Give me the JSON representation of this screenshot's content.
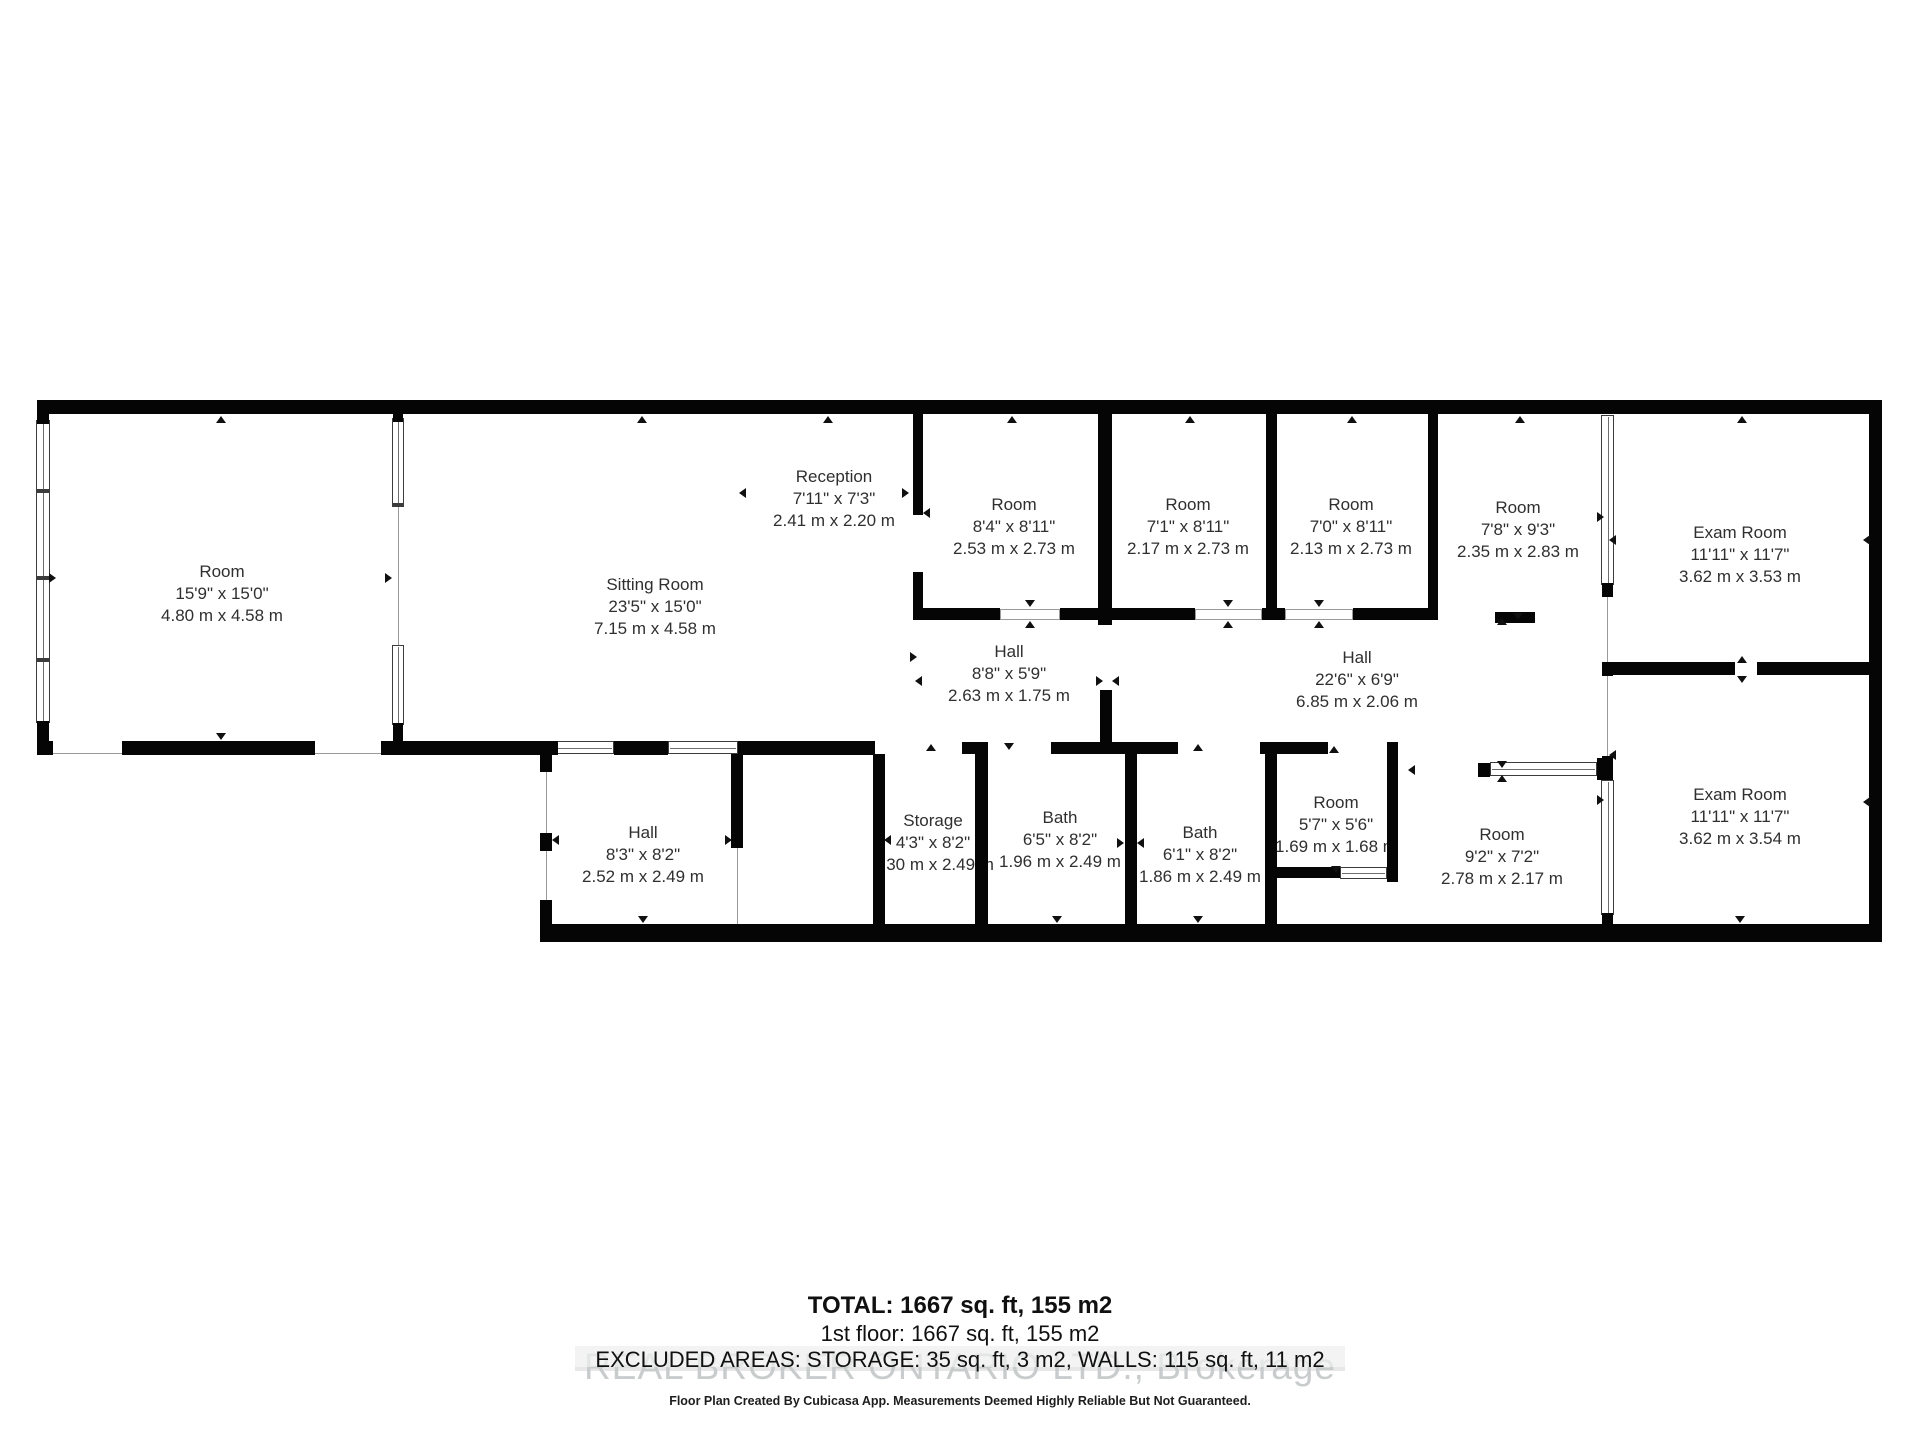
{
  "footer": {
    "total": "TOTAL: 1667 sq. ft, 155 m2",
    "floor": "1st floor: 1667 sq. ft, 155 m2",
    "excluded": "EXCLUDED AREAS: STORAGE: 35 sq. ft, 3 m2, WALLS: 115 sq. ft, 11 m2",
    "watermark": "REAL BROKER ONTARIO LTD., Brokerage",
    "disclaimer": "Floor Plan Created By Cubicasa App. Measurements Deemed Highly Reliable But Not Guaranteed."
  },
  "colors": {
    "wall": "#050505",
    "label_text": "#2f2f2f",
    "thin_line": "#9a9a9a",
    "watermark": "#c9cccd",
    "band": "#e7e7e7"
  },
  "rooms": [
    {
      "name": "Room",
      "imperial": "15'9\" x 15'0\"",
      "metric": "4.80 m x 4.58 m",
      "cx": 222,
      "top": 561
    },
    {
      "name": "Sitting Room",
      "imperial": "23'5\" x 15'0\"",
      "metric": "7.15 m x 4.58 m",
      "cx": 655,
      "top": 574
    },
    {
      "name": "Reception",
      "imperial": "7'11\" x 7'3\"",
      "metric": "2.41 m x 2.20 m",
      "cx": 834,
      "top": 466
    },
    {
      "name": "Room",
      "imperial": "8'4\" x 8'11\"",
      "metric": "2.53 m x 2.73 m",
      "cx": 1014,
      "top": 494
    },
    {
      "name": "Room",
      "imperial": "7'1\" x 8'11\"",
      "metric": "2.17 m x 2.73 m",
      "cx": 1188,
      "top": 494
    },
    {
      "name": "Room",
      "imperial": "7'0\" x 8'11\"",
      "metric": "2.13 m x 2.73 m",
      "cx": 1351,
      "top": 494
    },
    {
      "name": "Room",
      "imperial": "7'8\" x 9'3\"",
      "metric": "2.35 m x 2.83 m",
      "cx": 1518,
      "top": 497
    },
    {
      "name": "Exam Room",
      "imperial": "11'11\" x 11'7\"",
      "metric": "3.62 m x 3.53 m",
      "cx": 1740,
      "top": 522
    },
    {
      "name": "Hall",
      "imperial": "8'8\" x 5'9\"",
      "metric": "2.63 m x 1.75 m",
      "cx": 1009,
      "top": 641
    },
    {
      "name": "Hall",
      "imperial": "22'6\" x 6'9\"",
      "metric": "6.85 m x 2.06 m",
      "cx": 1357,
      "top": 647
    },
    {
      "name": "Exam Room",
      "imperial": "11'11\" x 11'7\"",
      "metric": "3.62 m x 3.54 m",
      "cx": 1740,
      "top": 784
    },
    {
      "name": "Hall",
      "imperial": "8'3\" x 8'2\"",
      "metric": "2.52 m x 2.49 m",
      "cx": 643,
      "top": 822
    },
    {
      "name": "Storage",
      "imperial": "4'3\" x 8'2\"",
      "metric": "1.30 m x 2.49 m",
      "cx": 933,
      "top": 810
    },
    {
      "name": "Bath",
      "imperial": "6'5\" x 8'2\"",
      "metric": "1.96 m x 2.49 m",
      "cx": 1060,
      "top": 807
    },
    {
      "name": "Bath",
      "imperial": "6'1\" x 8'2\"",
      "metric": "1.86 m x 2.49 m",
      "cx": 1200,
      "top": 822
    },
    {
      "name": "Room",
      "imperial": "5'7\" x 5'6\"",
      "metric": "1.69 m x 1.68 m",
      "cx": 1336,
      "top": 792
    },
    {
      "name": "Room",
      "imperial": "9'2\" x 7'2\"",
      "metric": "2.78 m x 2.17 m",
      "cx": 1502,
      "top": 824
    }
  ],
  "plan": {
    "walls": [
      [
        37,
        400,
        1845,
        14
      ],
      [
        1869,
        400,
        13,
        542
      ],
      [
        37,
        414,
        12,
        10
      ],
      [
        37,
        721,
        12,
        22
      ],
      [
        37,
        741,
        16,
        14
      ],
      [
        393,
        414,
        10,
        8
      ],
      [
        393,
        723,
        10,
        18
      ],
      [
        913,
        414,
        10,
        101
      ],
      [
        913,
        572,
        10,
        36
      ],
      [
        1098,
        414,
        14,
        211
      ],
      [
        1100,
        690,
        12,
        52
      ],
      [
        1266,
        414,
        11,
        206
      ],
      [
        1428,
        414,
        10,
        206
      ],
      [
        913,
        608,
        87,
        12
      ],
      [
        1060,
        608,
        135,
        12
      ],
      [
        1262,
        608,
        23,
        12
      ],
      [
        1353,
        608,
        82,
        12
      ],
      [
        1495,
        612,
        40,
        11
      ],
      [
        122,
        741,
        193,
        14
      ],
      [
        381,
        741,
        177,
        14
      ],
      [
        614,
        741,
        54,
        14
      ],
      [
        738,
        741,
        137,
        14
      ],
      [
        962,
        742,
        26,
        12
      ],
      [
        1051,
        742,
        127,
        12
      ],
      [
        1260,
        742,
        68,
        12
      ],
      [
        1387,
        742,
        11,
        12
      ],
      [
        873,
        754,
        12,
        172
      ],
      [
        975,
        754,
        13,
        172
      ],
      [
        1125,
        754,
        12,
        172
      ],
      [
        1265,
        742,
        12,
        184
      ],
      [
        1387,
        754,
        11,
        128
      ],
      [
        1277,
        867,
        63,
        11
      ],
      [
        1387,
        867,
        11,
        15
      ],
      [
        540,
        754,
        12,
        18
      ],
      [
        540,
        833,
        12,
        18
      ],
      [
        540,
        900,
        12,
        26
      ],
      [
        731,
        754,
        12,
        94
      ],
      [
        540,
        924,
        1342,
        18
      ],
      [
        1478,
        763,
        12,
        14
      ],
      [
        1597,
        758,
        16,
        22
      ],
      [
        1602,
        583,
        11,
        14
      ],
      [
        1602,
        662,
        11,
        14
      ],
      [
        1602,
        756,
        11,
        24
      ],
      [
        1602,
        913,
        11,
        17
      ],
      [
        1613,
        662,
        122,
        13
      ],
      [
        1757,
        662,
        113,
        13
      ]
    ],
    "windows_v": [
      [
        36,
        420,
        14,
        303
      ],
      [
        392,
        418,
        12,
        88
      ],
      [
        392,
        645,
        12,
        80
      ],
      [
        1601,
        415,
        13,
        170
      ],
      [
        1601,
        780,
        13,
        135
      ]
    ],
    "windows_h": [
      [
        556,
        741,
        58,
        13
      ],
      [
        668,
        741,
        70,
        13
      ],
      [
        1490,
        762,
        107,
        14
      ],
      [
        1340,
        867,
        47,
        12
      ]
    ],
    "mullions": [
      [
        36,
        489,
        14,
        4
      ],
      [
        36,
        576,
        14,
        4
      ],
      [
        36,
        658,
        14,
        4
      ],
      [
        392,
        503,
        12,
        4
      ]
    ],
    "openings": [
      [
        1000,
        609,
        60,
        11
      ],
      [
        1195,
        609,
        67,
        11
      ],
      [
        1285,
        609,
        68,
        11
      ]
    ],
    "lines": [
      [
        398,
        506,
        1,
        139
      ],
      [
        53,
        753,
        69,
        1
      ],
      [
        315,
        753,
        66,
        1
      ],
      [
        546,
        772,
        1,
        130
      ],
      [
        737,
        848,
        1,
        76
      ],
      [
        1607,
        597,
        1,
        65
      ],
      [
        1607,
        676,
        1,
        80
      ]
    ],
    "arrows": [
      [
        221,
        420,
        "up"
      ],
      [
        642,
        420,
        "up"
      ],
      [
        828,
        420,
        "up"
      ],
      [
        1012,
        420,
        "up"
      ],
      [
        1190,
        420,
        "up"
      ],
      [
        1352,
        420,
        "up"
      ],
      [
        1520,
        420,
        "up"
      ],
      [
        1742,
        420,
        "up"
      ],
      [
        52,
        578,
        "right"
      ],
      [
        388,
        578,
        "right"
      ],
      [
        221,
        736,
        "down"
      ],
      [
        905,
        493,
        "right"
      ],
      [
        927,
        513,
        "left"
      ],
      [
        743,
        493,
        "left"
      ],
      [
        1030,
        603,
        "down"
      ],
      [
        1030,
        625,
        "up"
      ],
      [
        1228,
        603,
        "down"
      ],
      [
        1228,
        625,
        "up"
      ],
      [
        1319,
        603,
        "down"
      ],
      [
        1319,
        625,
        "up"
      ],
      [
        1502,
        622,
        "up"
      ],
      [
        1518,
        616,
        "down"
      ],
      [
        1099,
        681,
        "right"
      ],
      [
        1116,
        681,
        "left"
      ],
      [
        913,
        657,
        "right"
      ],
      [
        919,
        681,
        "left"
      ],
      [
        931,
        748,
        "up"
      ],
      [
        1009,
        746,
        "down"
      ],
      [
        1198,
        748,
        "up"
      ],
      [
        1334,
        750,
        "up"
      ],
      [
        556,
        840,
        "left"
      ],
      [
        728,
        840,
        "right"
      ],
      [
        888,
        840,
        "left"
      ],
      [
        1120,
        843,
        "right"
      ],
      [
        1141,
        843,
        "left"
      ],
      [
        1336,
        869,
        "down"
      ],
      [
        643,
        919,
        "down"
      ],
      [
        1057,
        919,
        "down"
      ],
      [
        1198,
        919,
        "down"
      ],
      [
        1740,
        919,
        "down"
      ],
      [
        1600,
        517,
        "right"
      ],
      [
        1613,
        540,
        "left"
      ],
      [
        1613,
        755,
        "left"
      ],
      [
        1600,
        800,
        "right"
      ],
      [
        1742,
        660,
        "up"
      ],
      [
        1742,
        679,
        "down"
      ],
      [
        1867,
        540,
        "left"
      ],
      [
        1867,
        802,
        "left"
      ],
      [
        1502,
        764,
        "down"
      ],
      [
        1502,
        779,
        "up"
      ],
      [
        1412,
        770,
        "left"
      ]
    ]
  }
}
